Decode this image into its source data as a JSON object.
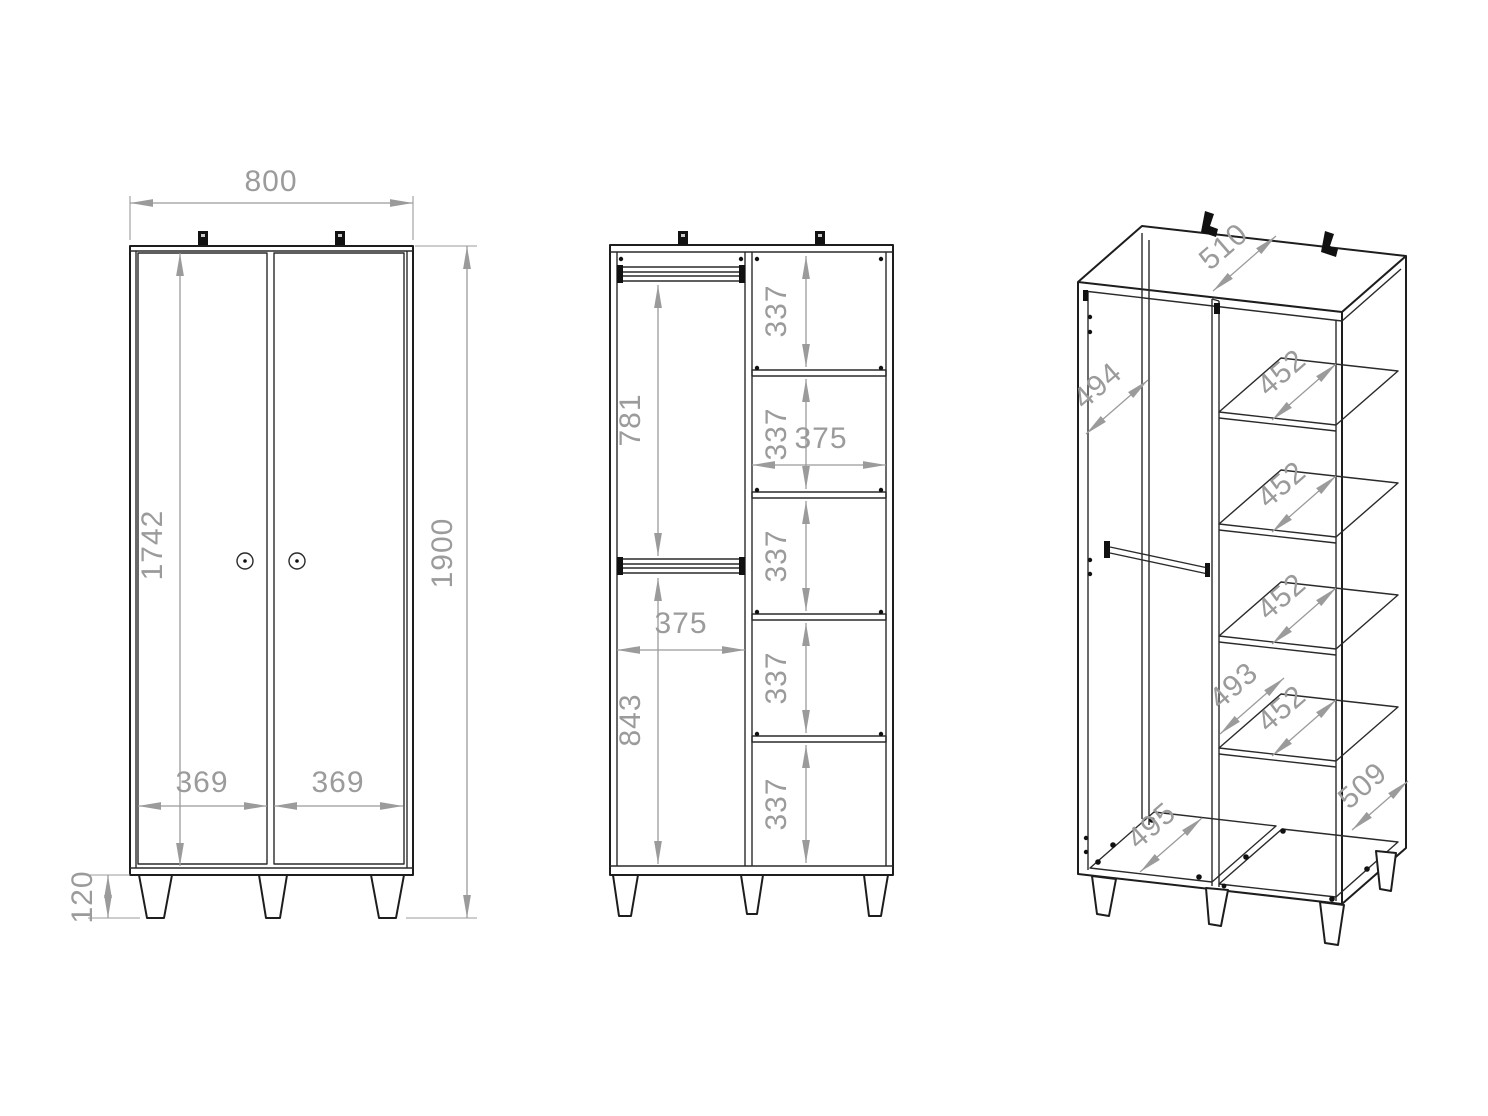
{
  "drawing": {
    "type": "furniture technical drawing - two-door wardrobe",
    "colors": {
      "line": "#1d1d1d",
      "dimension": "#9b9b9b",
      "background": "#ffffff"
    }
  },
  "views": {
    "front": {
      "width": "800",
      "height": "1900",
      "door_panel_height": "1742",
      "left_door_width": "369",
      "right_door_width": "369",
      "leg_height": "120"
    },
    "section": {
      "upper_section_height": "781",
      "lower_section_height": "843",
      "left_compartment_width": "375",
      "right_compartment_width": "375",
      "shelf_gaps": [
        "337",
        "337",
        "337",
        "337",
        "337"
      ]
    },
    "perspective": {
      "top_depth": "510",
      "side_panel_depth": "494",
      "shelf_depths": [
        "452",
        "452",
        "452",
        "452"
      ],
      "compartment_depth": "493",
      "bottom_panel_depth": "495",
      "side_bottom_depth": "509"
    }
  }
}
